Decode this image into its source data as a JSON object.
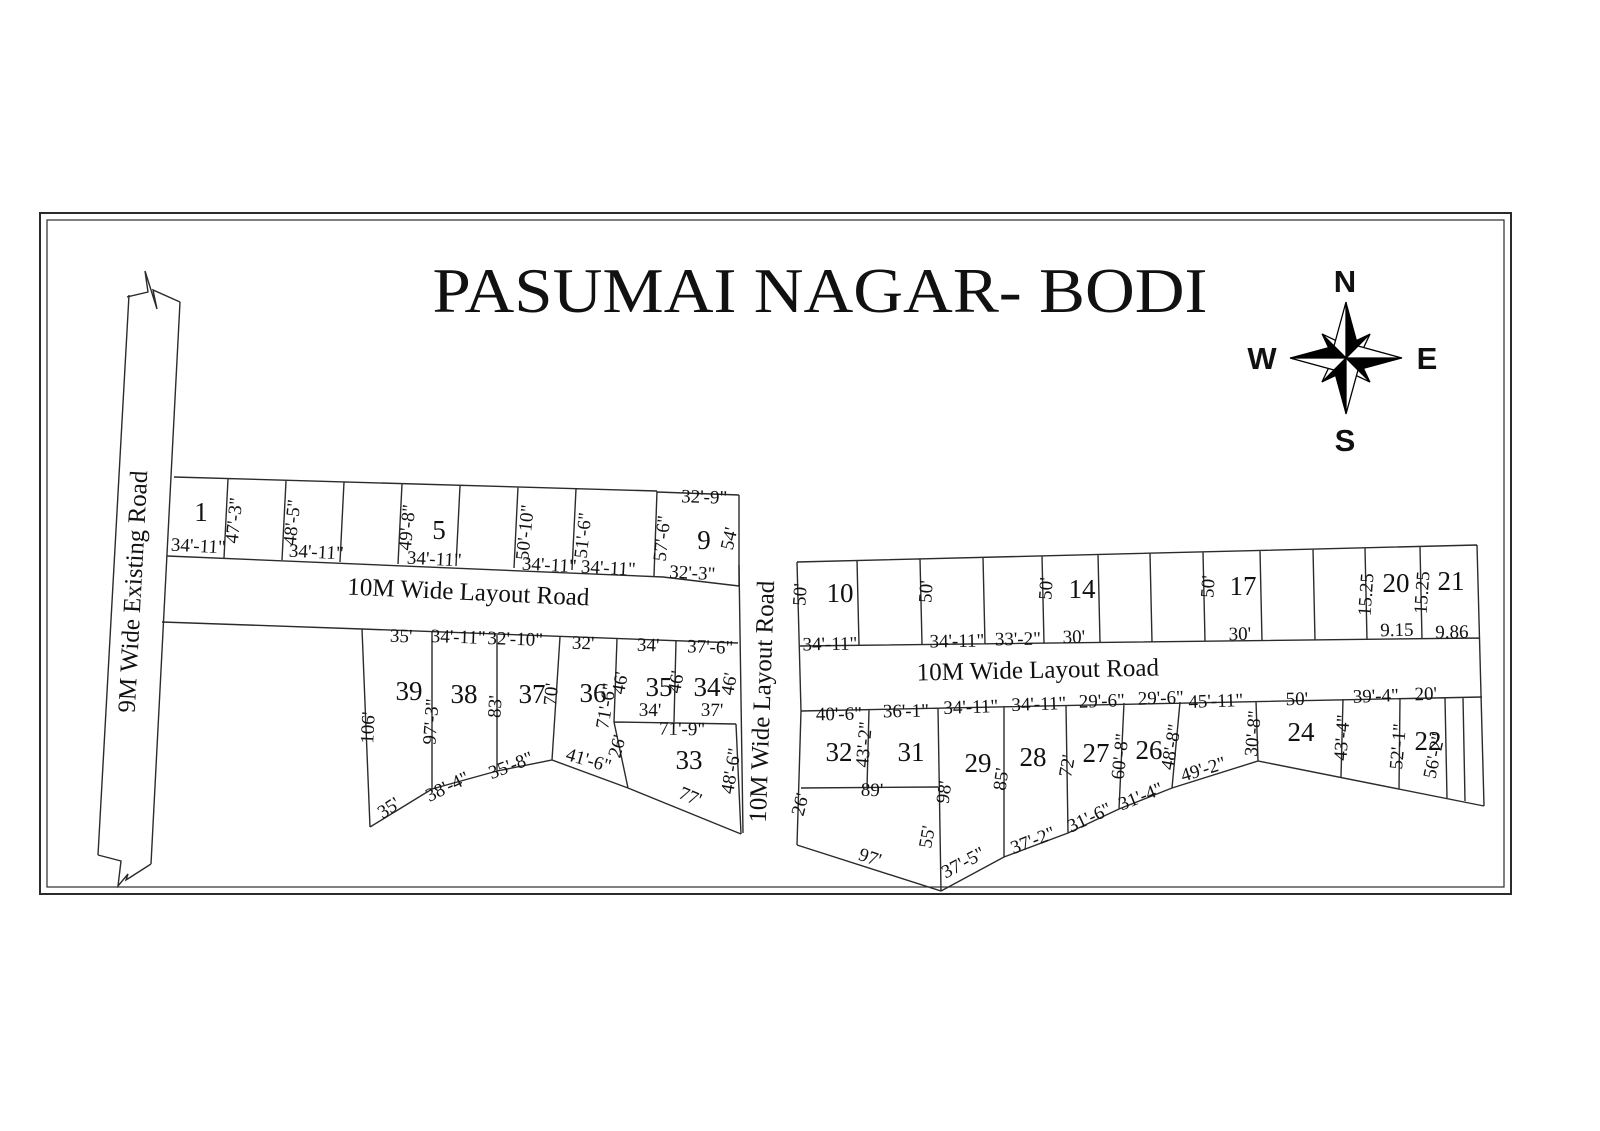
{
  "title": {
    "text": "PASUMAI NAGAR- BODI"
  },
  "compass": {
    "n": {
      "t": "N",
      "x": 1345,
      "y": 292
    },
    "e": {
      "t": "E",
      "x": 1427,
      "y": 369
    },
    "s": {
      "t": "S",
      "x": 1345,
      "y": 451
    },
    "w": {
      "t": "W",
      "x": 1262,
      "y": 369
    }
  },
  "roads": [
    {
      "label": "9M Wide Existing Road",
      "x": 141,
      "y": 592,
      "r": -87
    },
    {
      "label": "10M Wide Layout Road",
      "x": 468,
      "y": 600,
      "r": 2.6
    },
    {
      "label": "10M Wide Layout Road",
      "x": 770,
      "y": 702,
      "r": -88
    },
    {
      "label": "10M Wide Layout Road",
      "x": 1038,
      "y": 678,
      "r": -1.2
    }
  ],
  "plot_numbers": [
    {
      "n": "1",
      "x": 201,
      "y": 521
    },
    {
      "n": "5",
      "x": 439,
      "y": 539
    },
    {
      "n": "9",
      "x": 704,
      "y": 549
    },
    {
      "n": "10",
      "x": 840,
      "y": 602
    },
    {
      "n": "14",
      "x": 1082,
      "y": 598
    },
    {
      "n": "17",
      "x": 1243,
      "y": 595
    },
    {
      "n": "20",
      "x": 1396,
      "y": 592
    },
    {
      "n": "21",
      "x": 1451,
      "y": 590
    },
    {
      "n": "39",
      "x": 409,
      "y": 700
    },
    {
      "n": "38",
      "x": 464,
      "y": 703
    },
    {
      "n": "37",
      "x": 532,
      "y": 703
    },
    {
      "n": "36",
      "x": 593,
      "y": 702
    },
    {
      "n": "35",
      "x": 659,
      "y": 696
    },
    {
      "n": "34",
      "x": 707,
      "y": 696
    },
    {
      "n": "33",
      "x": 689,
      "y": 769
    },
    {
      "n": "32",
      "x": 839,
      "y": 761
    },
    {
      "n": "31",
      "x": 911,
      "y": 761
    },
    {
      "n": "29",
      "x": 978,
      "y": 772
    },
    {
      "n": "28",
      "x": 1033,
      "y": 766
    },
    {
      "n": "27",
      "x": 1096,
      "y": 762
    },
    {
      "n": "26",
      "x": 1149,
      "y": 759
    },
    {
      "n": "24",
      "x": 1301,
      "y": 741
    },
    {
      "n": "22",
      "x": 1428,
      "y": 750
    }
  ],
  "dimensions": [
    {
      "t": "47'-3\"",
      "x": 240,
      "y": 521,
      "r": -84
    },
    {
      "t": "48'-5\"",
      "x": 298,
      "y": 523,
      "r": -84
    },
    {
      "t": "49'-8\"",
      "x": 413,
      "y": 528,
      "r": -84
    },
    {
      "t": "50'-10\"",
      "x": 531,
      "y": 533,
      "r": -84
    },
    {
      "t": "51'-6\"",
      "x": 589,
      "y": 536,
      "r": -84
    },
    {
      "t": "57'-6\"",
      "x": 668,
      "y": 539,
      "r": -84
    },
    {
      "t": "54'",
      "x": 735,
      "y": 540,
      "r": -77
    },
    {
      "t": "32'-9\"",
      "x": 704,
      "y": 503,
      "r": 2
    },
    {
      "t": "34'-11\"",
      "x": 198,
      "y": 552,
      "r": 3
    },
    {
      "t": "34'-11\"",
      "x": 316,
      "y": 558,
      "r": 3
    },
    {
      "t": "34'-11\"",
      "x": 434,
      "y": 565,
      "r": 3
    },
    {
      "t": "34'-11\"",
      "x": 549,
      "y": 571,
      "r": 3
    },
    {
      "t": "34'-11\"",
      "x": 608,
      "y": 574,
      "r": 3
    },
    {
      "t": "32'-3\"",
      "x": 692,
      "y": 579,
      "r": 3
    },
    {
      "t": "50'",
      "x": 806,
      "y": 595,
      "r": -86
    },
    {
      "t": "50'",
      "x": 932,
      "y": 592,
      "r": -86
    },
    {
      "t": "50'",
      "x": 1052,
      "y": 589,
      "r": -86
    },
    {
      "t": "50'",
      "x": 1214,
      "y": 587,
      "r": -86
    },
    {
      "t": "15.25",
      "x": 1372,
      "y": 595,
      "r": -86
    },
    {
      "t": "15.25",
      "x": 1428,
      "y": 593,
      "r": -86
    },
    {
      "t": "34'-11\"",
      "x": 830,
      "y": 650,
      "r": -1
    },
    {
      "t": "34'-11\"",
      "x": 957,
      "y": 647,
      "r": -1
    },
    {
      "t": "33'-2\"",
      "x": 1018,
      "y": 645,
      "r": -1
    },
    {
      "t": "30'",
      "x": 1074,
      "y": 643,
      "r": -1
    },
    {
      "t": "30'",
      "x": 1240,
      "y": 640,
      "r": -1
    },
    {
      "t": "9.15",
      "x": 1397,
      "y": 636,
      "r": -1
    },
    {
      "t": "9.86",
      "x": 1452,
      "y": 638,
      "r": -1
    },
    {
      "t": "35'",
      "x": 401,
      "y": 642,
      "r": 2
    },
    {
      "t": "34'-11\"",
      "x": 458,
      "y": 643,
      "r": 2
    },
    {
      "t": "32'-10\"",
      "x": 515,
      "y": 645,
      "r": 2
    },
    {
      "t": "32'",
      "x": 583,
      "y": 649,
      "r": 2
    },
    {
      "t": "34'",
      "x": 648,
      "y": 651,
      "r": 2
    },
    {
      "t": "37'-6\"",
      "x": 710,
      "y": 653,
      "r": 2
    },
    {
      "t": "106'",
      "x": 374,
      "y": 728,
      "r": -87
    },
    {
      "t": "97'-3\"",
      "x": 437,
      "y": 722,
      "r": -86
    },
    {
      "t": "83'",
      "x": 501,
      "y": 707,
      "r": -86
    },
    {
      "t": "70'",
      "x": 557,
      "y": 695,
      "r": -84
    },
    {
      "t": "71'-6\"",
      "x": 612,
      "y": 707,
      "r": -80
    },
    {
      "t": "46'",
      "x": 626,
      "y": 684,
      "r": -80
    },
    {
      "t": "46'",
      "x": 682,
      "y": 683,
      "r": -80
    },
    {
      "t": "46'",
      "x": 735,
      "y": 685,
      "r": -80
    },
    {
      "t": "26'",
      "x": 623,
      "y": 748,
      "r": -74
    },
    {
      "t": "48'-6\"",
      "x": 737,
      "y": 772,
      "r": -80
    },
    {
      "t": "34'",
      "x": 650,
      "y": 716,
      "r": 1
    },
    {
      "t": "71'-9\"",
      "x": 682,
      "y": 735,
      "r": 1
    },
    {
      "t": "37'",
      "x": 712,
      "y": 716,
      "r": 1
    },
    {
      "t": "35'",
      "x": 392,
      "y": 813,
      "r": -33
    },
    {
      "t": "38'-4\"",
      "x": 450,
      "y": 792,
      "r": -26
    },
    {
      "t": "35'-8\"",
      "x": 513,
      "y": 771,
      "r": -21
    },
    {
      "t": "41'-6\"",
      "x": 587,
      "y": 766,
      "r": 16
    },
    {
      "t": "77'",
      "x": 688,
      "y": 802,
      "r": 23
    },
    {
      "t": "40'-6\"",
      "x": 839,
      "y": 720,
      "r": -1
    },
    {
      "t": "36'-1\"",
      "x": 906,
      "y": 717,
      "r": -1
    },
    {
      "t": "34'-11\"",
      "x": 971,
      "y": 713,
      "r": -2
    },
    {
      "t": "34'-11\"",
      "x": 1039,
      "y": 710,
      "r": -2
    },
    {
      "t": "29'-6\"",
      "x": 1102,
      "y": 707,
      "r": -2
    },
    {
      "t": "29'-6\"",
      "x": 1161,
      "y": 704,
      "r": -2
    },
    {
      "t": "45'-11\"",
      "x": 1216,
      "y": 707,
      "r": -2
    },
    {
      "t": "50'",
      "x": 1297,
      "y": 705,
      "r": -1
    },
    {
      "t": "39'-4\"",
      "x": 1376,
      "y": 702,
      "r": -2
    },
    {
      "t": "20'",
      "x": 1426,
      "y": 700,
      "r": -2
    },
    {
      "t": "43'-2\"",
      "x": 870,
      "y": 745,
      "r": -85
    },
    {
      "t": "98'",
      "x": 950,
      "y": 793,
      "r": -82
    },
    {
      "t": "55'",
      "x": 933,
      "y": 838,
      "r": -80
    },
    {
      "t": "85'",
      "x": 1007,
      "y": 780,
      "r": -82
    },
    {
      "t": "72'",
      "x": 1073,
      "y": 767,
      "r": -80
    },
    {
      "t": "60'-8\"",
      "x": 1126,
      "y": 757,
      "r": -84
    },
    {
      "t": "48'-8\"",
      "x": 1177,
      "y": 748,
      "r": -80
    },
    {
      "t": "30'-8\"",
      "x": 1259,
      "y": 734,
      "r": -85
    },
    {
      "t": "43'-4\"",
      "x": 1348,
      "y": 738,
      "r": -86
    },
    {
      "t": "52'-1\"",
      "x": 1404,
      "y": 747,
      "r": -85
    },
    {
      "t": "56'-2\"",
      "x": 1440,
      "y": 757,
      "r": -78
    },
    {
      "t": "26'",
      "x": 806,
      "y": 806,
      "r": -75
    },
    {
      "t": "89'",
      "x": 872,
      "y": 796,
      "r": 1
    },
    {
      "t": "97'",
      "x": 868,
      "y": 863,
      "r": 19
    },
    {
      "t": "37'-5\"",
      "x": 966,
      "y": 868,
      "r": -28
    },
    {
      "t": "37'-2\"",
      "x": 1035,
      "y": 846,
      "r": -21
    },
    {
      "t": "31'-6\"",
      "x": 1092,
      "y": 823,
      "r": -25
    },
    {
      "t": "31'-4\"",
      "x": 1143,
      "y": 802,
      "r": -22
    },
    {
      "t": "49'-2\"",
      "x": 1205,
      "y": 775,
      "r": -17
    }
  ]
}
